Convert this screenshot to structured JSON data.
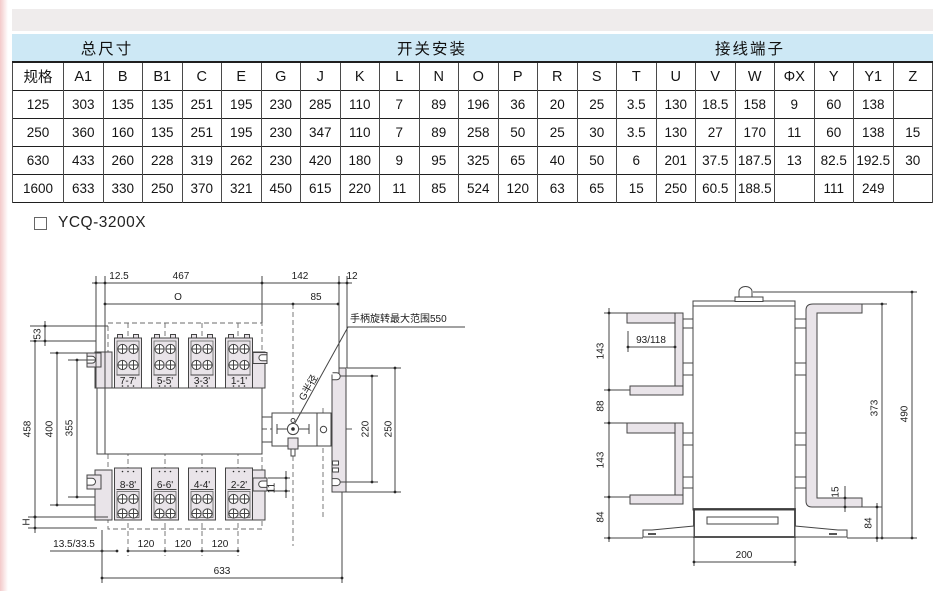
{
  "table": {
    "group_headers": [
      {
        "label": "总尺寸"
      },
      {
        "label": "开关安装"
      },
      {
        "label": "接线端子"
      }
    ],
    "columns": [
      "规格",
      "A1",
      "B",
      "B1",
      "C",
      "E",
      "G",
      "J",
      "K",
      "L",
      "N",
      "O",
      "P",
      "R",
      "S",
      "T",
      "U",
      "V",
      "W",
      "ΦX",
      "Y",
      "Y1",
      "Z"
    ],
    "rows": [
      [
        "125",
        "303",
        "135",
        "135",
        "251",
        "195",
        "230",
        "285",
        "110",
        "7",
        "89",
        "196",
        "36",
        "20",
        "25",
        "3.5",
        "130",
        "18.5",
        "158",
        "9",
        "60",
        "138",
        ""
      ],
      [
        "250",
        "360",
        "160",
        "135",
        "251",
        "195",
        "230",
        "347",
        "110",
        "7",
        "89",
        "258",
        "50",
        "25",
        "30",
        "3.5",
        "130",
        "27",
        "170",
        "11",
        "60",
        "138",
        "15"
      ],
      [
        "630",
        "433",
        "260",
        "228",
        "319",
        "262",
        "230",
        "420",
        "180",
        "9",
        "95",
        "325",
        "65",
        "40",
        "50",
        "6",
        "201",
        "37.5",
        "187.5",
        "13",
        "82.5",
        "192.5",
        "30"
      ],
      [
        "1600",
        "633",
        "330",
        "250",
        "370",
        "321",
        "450",
        "615",
        "220",
        "11",
        "85",
        "524",
        "120",
        "63",
        "65",
        "15",
        "250",
        "60.5",
        "188.5",
        "",
        "111",
        "249",
        ""
      ]
    ]
  },
  "model_label": "YCQ-3200X",
  "left_drawing": {
    "dims": {
      "top1": "12.5",
      "top2": "467",
      "top3": "142",
      "top4": "12",
      "o": "O",
      "d85": "85",
      "left53": "53",
      "left458": "458",
      "left400": "400",
      "left355": "355",
      "h": "H",
      "b1": "13.5/33.5",
      "b120a": "120",
      "b120b": "120",
      "b120c": "120",
      "b633": "633",
      "r220": "220",
      "r250": "250",
      "r11": "11"
    },
    "notes": {
      "handle": "手柄旋转最大范围550",
      "g_radius": "G半径"
    },
    "terminals_top": [
      "7-7'",
      "5-5'",
      "3-3'",
      "1-1'"
    ],
    "terminals_bottom": [
      "8-8'",
      "6-6'",
      "4-4'",
      "2-2'"
    ]
  },
  "right_drawing": {
    "dims": {
      "l143a": "143",
      "l88": "88",
      "l143b": "143",
      "l84": "84",
      "inner": "93/118",
      "r373": "373",
      "r490": "490",
      "r15": "15",
      "r84": "84",
      "b200": "200"
    }
  },
  "colors": {
    "header_band": "#cde8f5",
    "top_strip": "#efecec",
    "fill_light": "#e9e4e9",
    "line": "#454545"
  }
}
